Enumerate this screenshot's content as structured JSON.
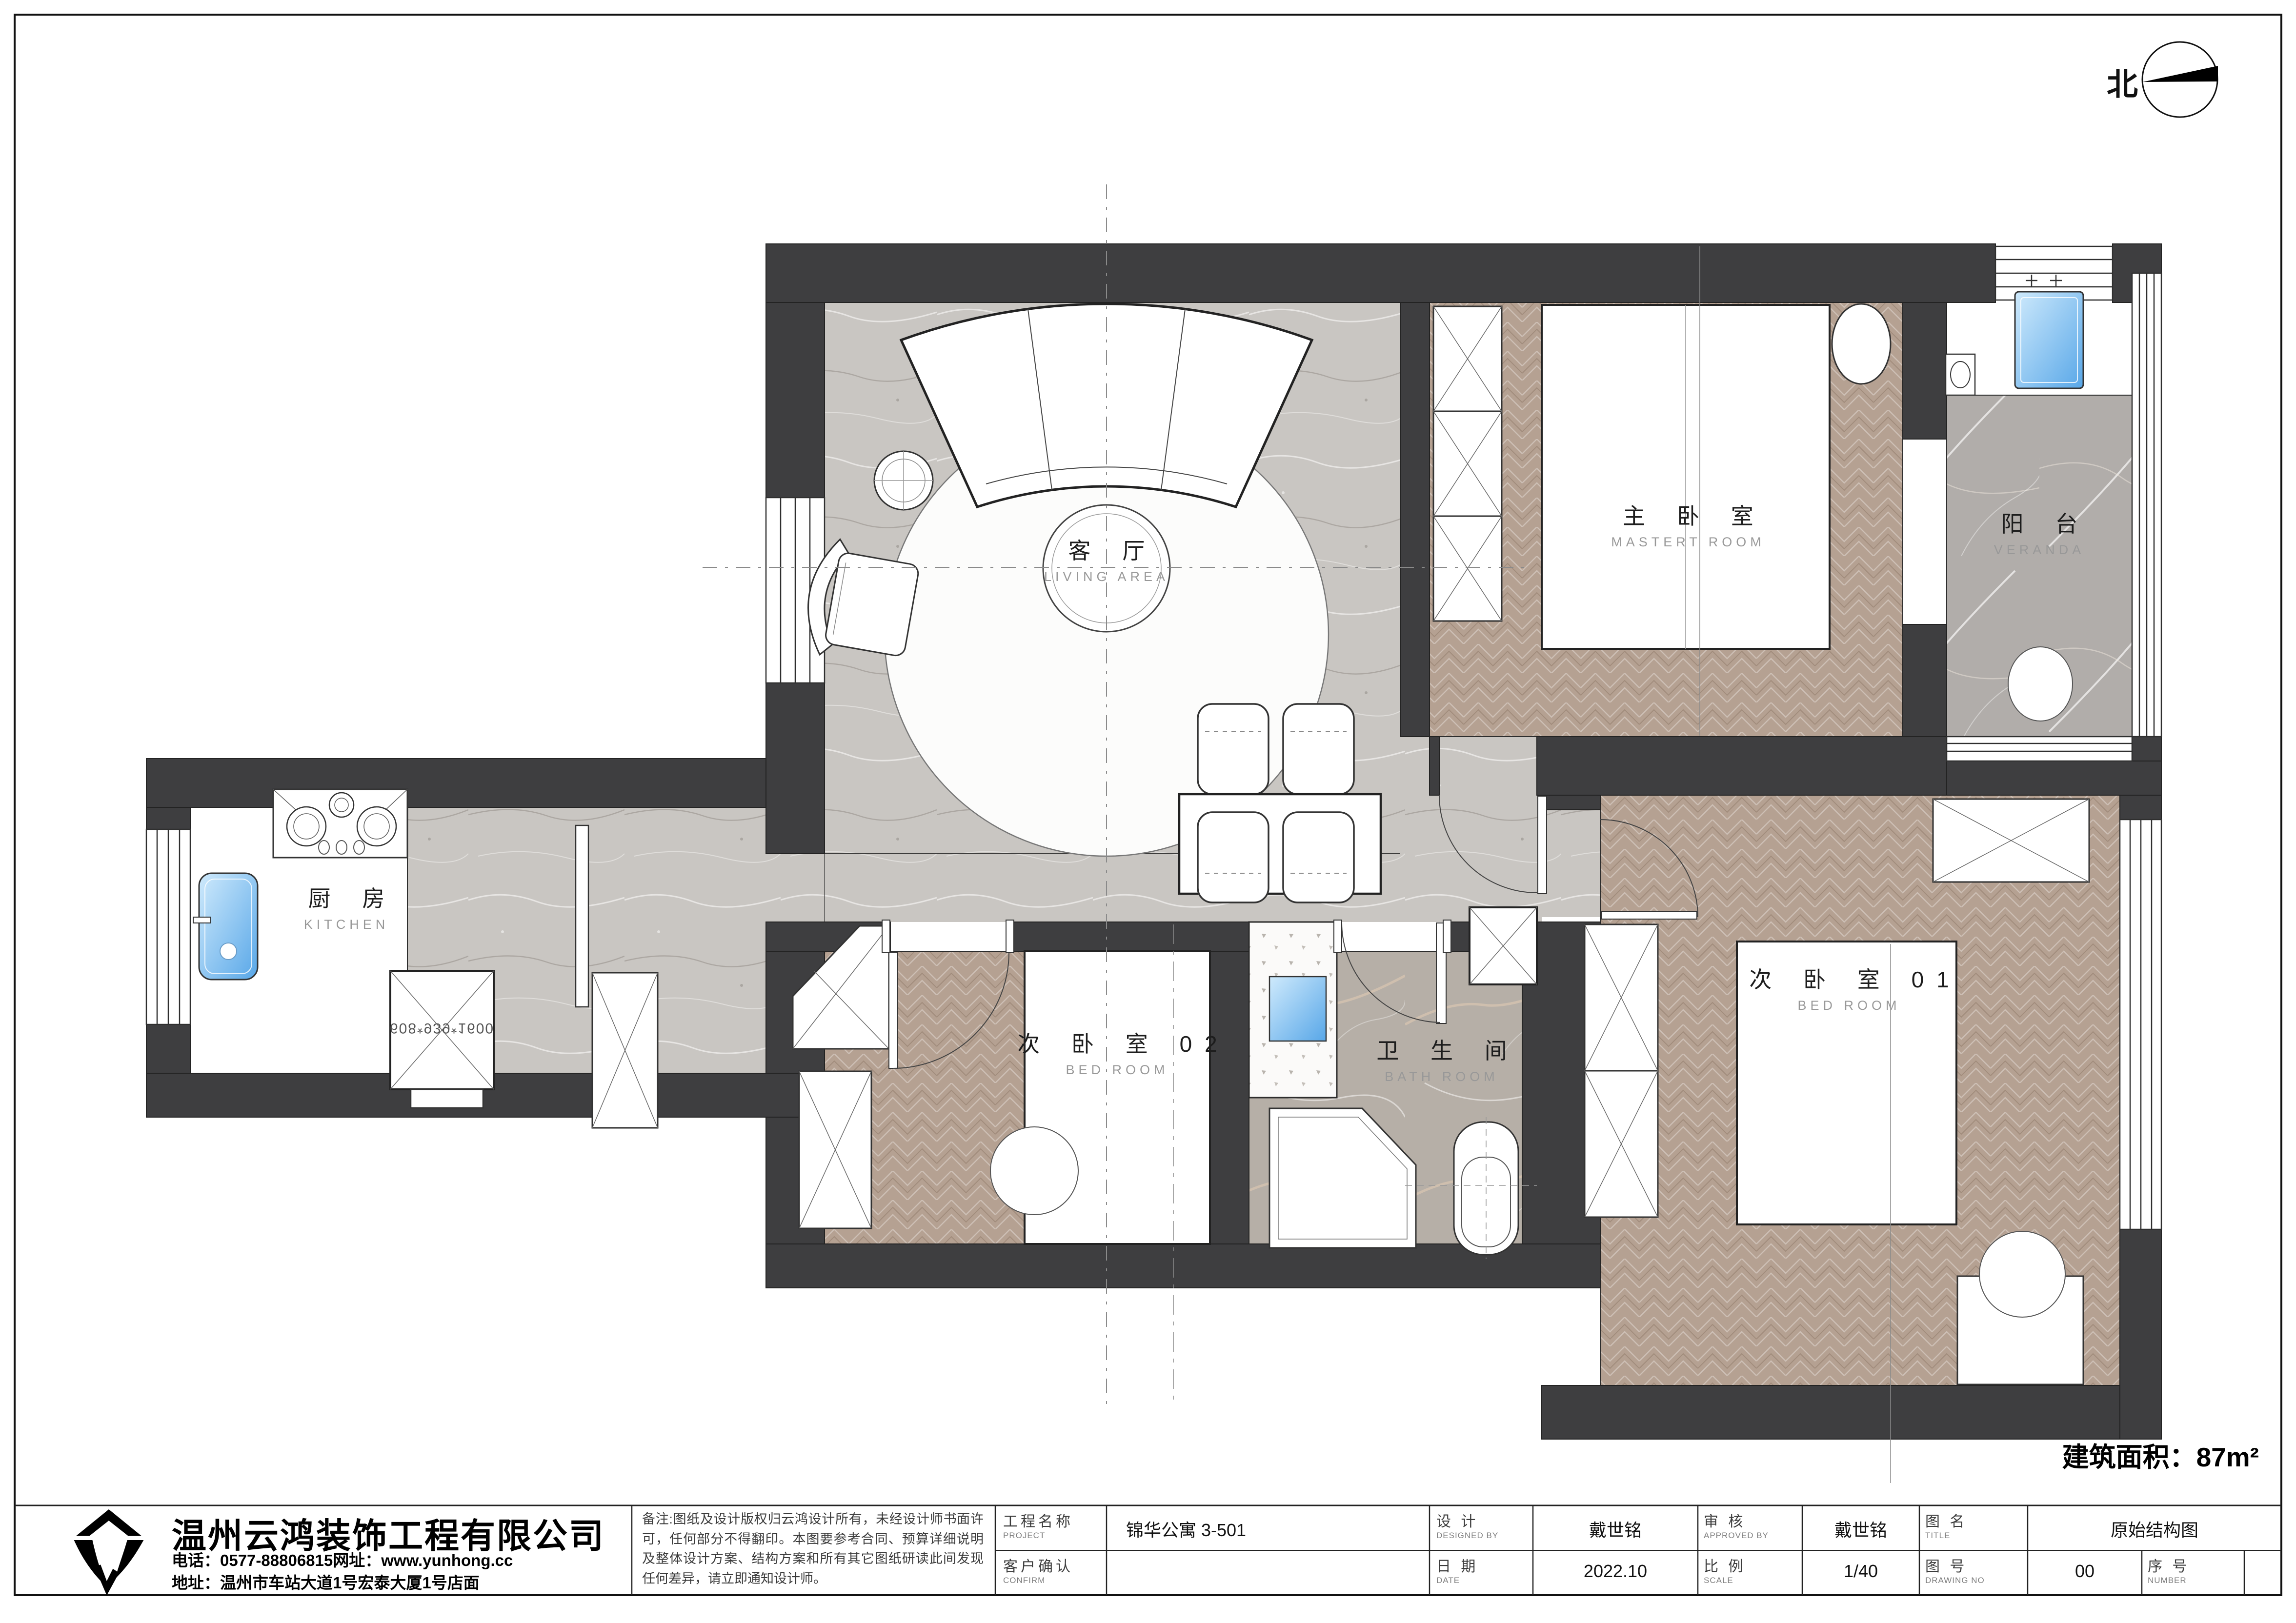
{
  "sheet": {
    "area_label": "建筑面积：87m²",
    "north_label": "北"
  },
  "rooms": [
    {
      "id": "living",
      "zh": "客 厅",
      "en": "LIVING AREA"
    },
    {
      "id": "master",
      "zh": "主 卧 室",
      "en": "MASTERT ROOM"
    },
    {
      "id": "veranda",
      "zh": "阳 台",
      "en": "VERANDA"
    },
    {
      "id": "kitchen",
      "zh": "厨 房",
      "en": "KITCHEN"
    },
    {
      "id": "bed02",
      "zh": "次 卧 室 02",
      "en": "BED ROOM"
    },
    {
      "id": "bath",
      "zh": "卫 生 间",
      "en": "BATH ROOM"
    },
    {
      "id": "bed01",
      "zh": "次 卧 室 01",
      "en": "BED ROOM"
    }
  ],
  "kitchen": {
    "cabinet_dim": "608*939*1600"
  },
  "company": {
    "name": "温州云鸿装饰工程有限公司",
    "phone_line": "电话：0577-88806815网址：www.yunhong.cc",
    "address_line": "地址：温州市车站大道1号宏泰大厦1号店面"
  },
  "notes": {
    "text": "备注:图纸及设计版权归云鸿设计所有，未经设计师书面许可，任何部分不得翻印。本图要参考合同、预算详细说明及整体设计方案、结构方案和所有其它图纸研读此间发现任何差异，请立即通知设计师。"
  },
  "titleblock": {
    "project": {
      "zh": "工程名称",
      "en": "PROJECT",
      "value": "锦华公寓 3-501"
    },
    "confirm": {
      "zh": "客户确认",
      "en": "CONFIRM",
      "value": ""
    },
    "designed": {
      "zh": "设 计",
      "en": "DESIGNED BY",
      "value": "戴世铭"
    },
    "date": {
      "zh": "日 期",
      "en": "DATE",
      "value": "2022.10"
    },
    "approved": {
      "zh": "审 核",
      "en": "APPROVED BY",
      "value": "戴世铭"
    },
    "scale": {
      "zh": "比 例",
      "en": "SCALE",
      "value": "1/40"
    },
    "title": {
      "zh": "图 名",
      "en": "TITLE",
      "value": "原始结构图"
    },
    "drawing_no": {
      "zh": "图 号",
      "en": "DRAWING NO",
      "value": "00"
    },
    "number": {
      "zh": "序 号",
      "en": "NUMBER",
      "value": ""
    }
  }
}
